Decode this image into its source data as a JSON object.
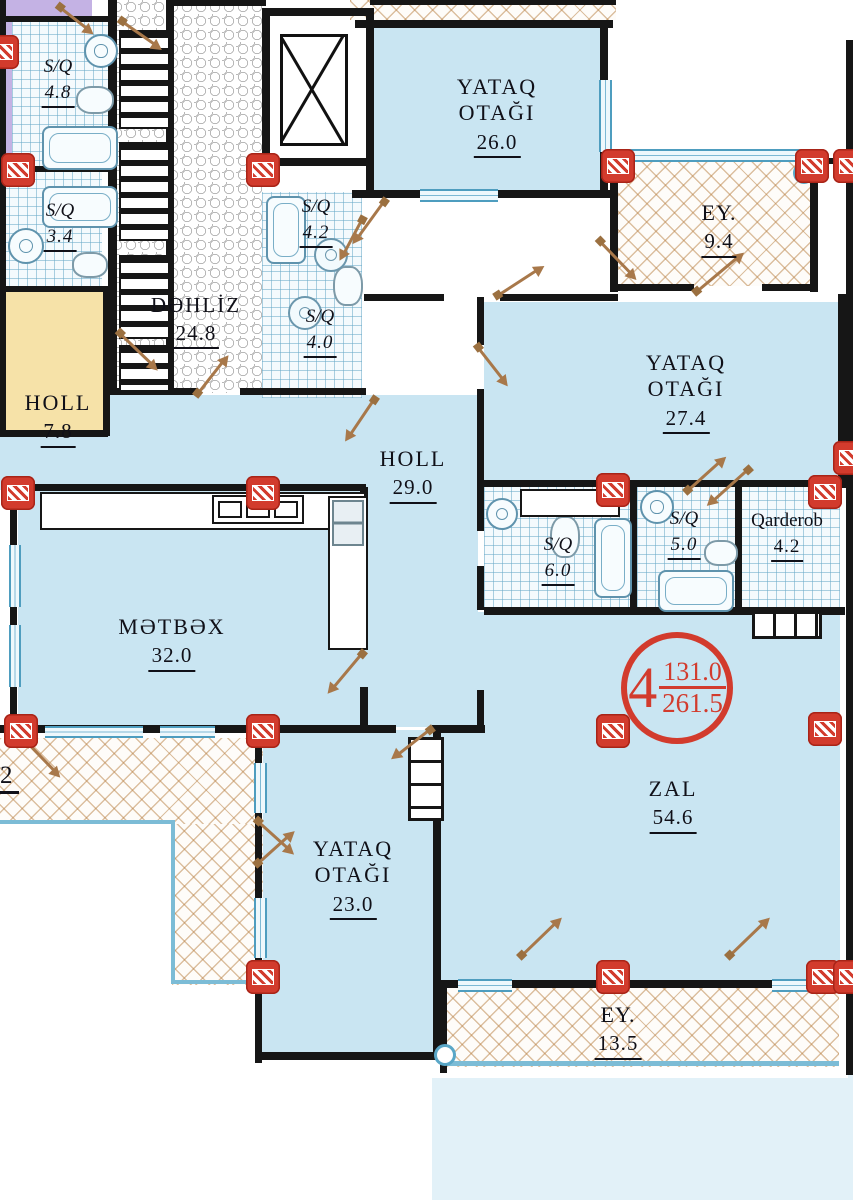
{
  "rooms": {
    "sq48": {
      "name": "S/Q",
      "area": "4.8"
    },
    "sq34": {
      "name": "S/Q",
      "area": "3.4"
    },
    "dehliz": {
      "name": "DƏHLİZ",
      "area": "24.8"
    },
    "holl7": {
      "name": "HOLL",
      "area": "7.8"
    },
    "yataq26": {
      "name_line1": "YATAQ",
      "name_line2": "OTAĞI",
      "area": "26.0"
    },
    "sq42": {
      "name": "S/Q",
      "area": "4.2"
    },
    "sq40": {
      "name": "S/Q",
      "area": "4.0"
    },
    "ey9": {
      "name": "EY.",
      "area": "9.4"
    },
    "yataq27": {
      "name_line1": "YATAQ",
      "name_line2": "OTAĞI",
      "area": "27.4"
    },
    "holl29": {
      "name": "HOLL",
      "area": "29.0"
    },
    "sq60": {
      "name": "S/Q",
      "area": "6.0"
    },
    "sq50": {
      "name": "S/Q",
      "area": "5.0"
    },
    "qarderob": {
      "name": "Qarderob",
      "area": "4.2"
    },
    "metbex": {
      "name": "MƏTBƏX",
      "area": "32.0"
    },
    "zal": {
      "name": "ZAL",
      "area": "54.6"
    },
    "yataq23": {
      "name_line1": "YATAQ",
      "name_line2": "OTAĞI",
      "area": "23.0"
    },
    "ey13": {
      "name": "EY.",
      "area": "13.5"
    }
  },
  "unit_badge": {
    "number": "4",
    "area_upper": "131.0",
    "area_lower": "261.5"
  },
  "edge_label": {
    "partial_area": "2"
  },
  "colors": {
    "room_fill": "#c9e5f2",
    "accent_red": "#d23b2d",
    "wall": "#161616",
    "hatch_tan": "#b98246",
    "window_blue": "#4e9dbf",
    "holl_yellow": "#f6e2a8",
    "purple": "#c4b2e4"
  }
}
